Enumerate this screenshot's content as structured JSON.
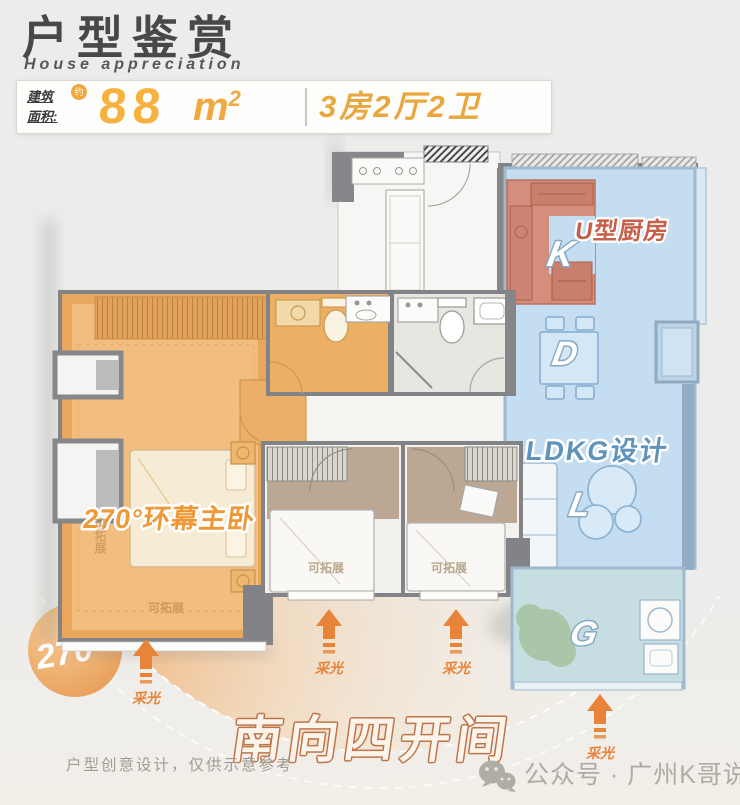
{
  "header": {
    "title": "户型鉴赏",
    "subtitle": "House appreciation",
    "area_label_line1": "建筑",
    "area_label_line2": "面积:",
    "approx_badge": "约",
    "area_value": "88",
    "area_unit_base": "m",
    "area_unit_exp": "2",
    "layout": "3房2厅2卫"
  },
  "plan": {
    "master_bedroom_label": "270°环幕主卧",
    "kitchen_label": "U型厨房",
    "kitchen_letter": "K",
    "dining_letter": "D",
    "living_letter": "L",
    "balcony_letter": "G",
    "ldkg_label": "LDKG设计",
    "expandable_label": "可拓展",
    "daylight_label": "采光",
    "angle_badge": "270°",
    "south_banner": "南向四开间"
  },
  "footer": {
    "disclaimer": "户型创意设计，仅供示意参考",
    "watermark": "公众号 · 广州K哥说房"
  },
  "colors": {
    "master_orange": "#E9A65D",
    "kitchen_salmon": "#D58E7B",
    "ldkg_blue": "#C4DDF0",
    "balcony_teal": "#C6DEE2",
    "wall_gray": "#818386",
    "accent_orange": "#E8833A",
    "area_orange": "#F0A93F",
    "banner_outline": "#BE7348"
  }
}
